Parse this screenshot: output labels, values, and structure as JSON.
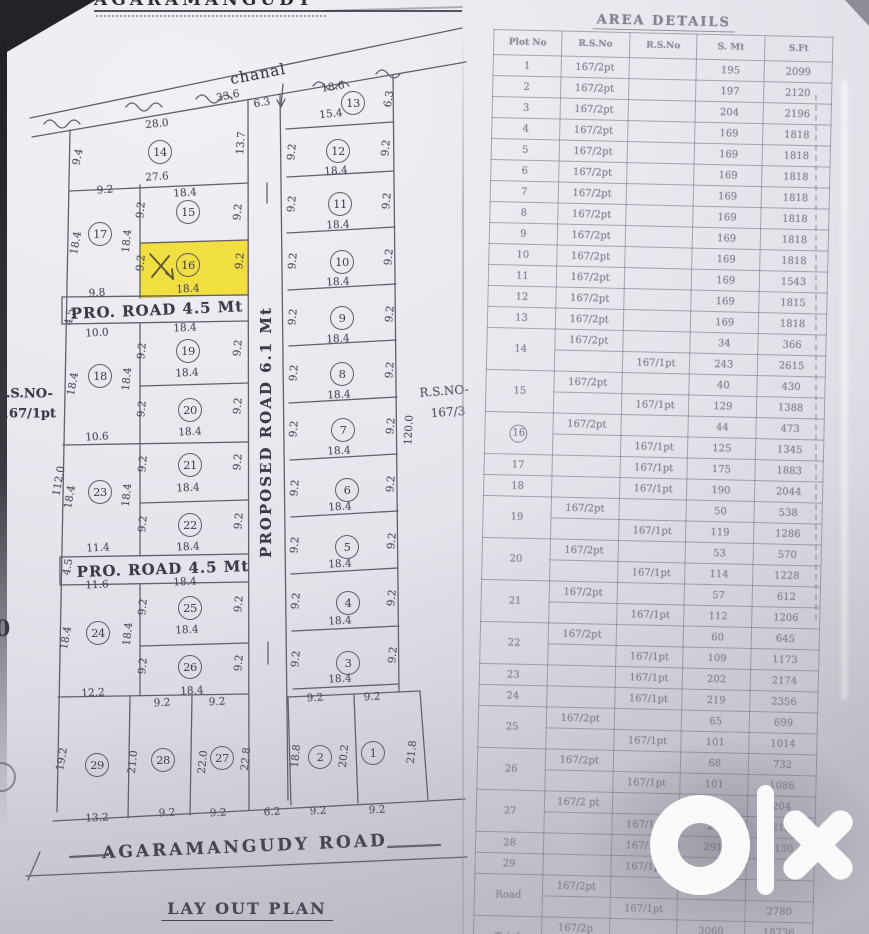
{
  "page": {
    "top_title": "AGARAMANGUDY",
    "layout_title": "LAY OUT PLAN"
  },
  "plan": {
    "channel_label": "chanal",
    "road_pro_1": "PRO. ROAD 4.5 Mt",
    "road_pro_2": "PRO. ROAD 4.5 Mt",
    "road_proposed": "PROPOSED ROAD 6.1 Mt",
    "road_main": "AGARAMANGUDY ROAD",
    "rs_left_line1": "R.S.NO-",
    "rs_left_line2": "167/1pt",
    "rs_right_line1": "R.S.NO-",
    "rs_right_line2": "167/3",
    "artifact_zero": "0",
    "highlight_color": "#f2df39",
    "highlighted_plot": "16",
    "plots": [
      {
        "n": "1",
        "x": 373,
        "y": 753
      },
      {
        "n": "2",
        "x": 320,
        "y": 757
      },
      {
        "n": "3",
        "x": 348,
        "y": 663
      },
      {
        "n": "4",
        "x": 348,
        "y": 603
      },
      {
        "n": "5",
        "x": 347,
        "y": 547
      },
      {
        "n": "6",
        "x": 347,
        "y": 490
      },
      {
        "n": "7",
        "x": 343,
        "y": 430
      },
      {
        "n": "8",
        "x": 342,
        "y": 374
      },
      {
        "n": "9",
        "x": 342,
        "y": 318
      },
      {
        "n": "10",
        "x": 342,
        "y": 262
      },
      {
        "n": "11",
        "x": 340,
        "y": 204
      },
      {
        "n": "12",
        "x": 338,
        "y": 151
      },
      {
        "n": "13",
        "x": 353,
        "y": 103
      },
      {
        "n": "14",
        "x": 160,
        "y": 152
      },
      {
        "n": "15",
        "x": 188,
        "y": 212
      },
      {
        "n": "16",
        "x": 188,
        "y": 265
      },
      {
        "n": "17",
        "x": 100,
        "y": 234
      },
      {
        "n": "18",
        "x": 100,
        "y": 376
      },
      {
        "n": "19",
        "x": 188,
        "y": 351
      },
      {
        "n": "20",
        "x": 190,
        "y": 410
      },
      {
        "n": "21",
        "x": 190,
        "y": 465
      },
      {
        "n": "22",
        "x": 190,
        "y": 525
      },
      {
        "n": "23",
        "x": 100,
        "y": 492
      },
      {
        "n": "24",
        "x": 98,
        "y": 633
      },
      {
        "n": "25",
        "x": 190,
        "y": 608
      },
      {
        "n": "26",
        "x": 190,
        "y": 667
      },
      {
        "n": "27",
        "x": 222,
        "y": 758
      },
      {
        "n": "28",
        "x": 163,
        "y": 760
      },
      {
        "n": "29",
        "x": 97,
        "y": 765
      }
    ],
    "dims": [
      {
        "t": "28.0",
        "x": 157,
        "y": 124,
        "r": -6
      },
      {
        "t": "27.6",
        "x": 157,
        "y": 177,
        "r": -4
      },
      {
        "t": "9.4",
        "x": 78,
        "y": 157,
        "r": -78
      },
      {
        "t": "13.7",
        "x": 241,
        "y": 143,
        "r": -86
      },
      {
        "t": "33.6",
        "x": 228,
        "y": 96,
        "r": -12
      },
      {
        "t": "6.3",
        "x": 262,
        "y": 103,
        "r": -10
      },
      {
        "t": "18.6",
        "x": 333,
        "y": 87,
        "r": -9
      },
      {
        "t": "15.4",
        "x": 331,
        "y": 114,
        "r": -6
      },
      {
        "t": "6.3",
        "x": 389,
        "y": 99,
        "r": -82
      },
      {
        "t": "9.2",
        "x": 292,
        "y": 152,
        "r": -84
      },
      {
        "t": "9.2",
        "x": 386,
        "y": 148,
        "r": -84
      },
      {
        "t": "18.4",
        "x": 336,
        "y": 171,
        "r": -4
      },
      {
        "t": "9.2",
        "x": 292,
        "y": 204,
        "r": -84
      },
      {
        "t": "9.2",
        "x": 387,
        "y": 201,
        "r": -84
      },
      {
        "t": "18.4",
        "x": 338,
        "y": 225,
        "r": -3
      },
      {
        "t": "9.2",
        "x": 293,
        "y": 261,
        "r": -84
      },
      {
        "t": "9.2",
        "x": 389,
        "y": 257,
        "r": -84
      },
      {
        "t": "18.4",
        "x": 338,
        "y": 282,
        "r": -3
      },
      {
        "t": "9.2",
        "x": 293,
        "y": 317,
        "r": -84
      },
      {
        "t": "9.2",
        "x": 390,
        "y": 314,
        "r": -84
      },
      {
        "t": "18.4",
        "x": 338,
        "y": 339,
        "r": -3
      },
      {
        "t": "9.2",
        "x": 294,
        "y": 373,
        "r": -84
      },
      {
        "t": "9.2",
        "x": 390,
        "y": 370,
        "r": -84
      },
      {
        "t": "18.4",
        "x": 339,
        "y": 395,
        "r": -3
      },
      {
        "t": "9.2",
        "x": 294,
        "y": 429,
        "r": -84
      },
      {
        "t": "9.2",
        "x": 391,
        "y": 426,
        "r": -84
      },
      {
        "t": "18.4",
        "x": 339,
        "y": 451,
        "r": -3
      },
      {
        "t": "9.2",
        "x": 295,
        "y": 488,
        "r": -84
      },
      {
        "t": "9.2",
        "x": 391,
        "y": 484,
        "r": -84
      },
      {
        "t": "18.4",
        "x": 340,
        "y": 507,
        "r": -3
      },
      {
        "t": "9.2",
        "x": 295,
        "y": 545,
        "r": -84
      },
      {
        "t": "9.2",
        "x": 392,
        "y": 541,
        "r": -84
      },
      {
        "t": "18.4",
        "x": 340,
        "y": 564,
        "r": -3
      },
      {
        "t": "9.2",
        "x": 296,
        "y": 601,
        "r": -84
      },
      {
        "t": "9.2",
        "x": 392,
        "y": 598,
        "r": -84
      },
      {
        "t": "18.4",
        "x": 340,
        "y": 621,
        "r": -3
      },
      {
        "t": "9.2",
        "x": 296,
        "y": 659,
        "r": -84
      },
      {
        "t": "9.2",
        "x": 393,
        "y": 655,
        "r": -84
      },
      {
        "t": "18.4",
        "x": 340,
        "y": 679,
        "r": -3
      },
      {
        "t": "120.0",
        "x": 409,
        "y": 430,
        "r": -87
      },
      {
        "t": "9.2",
        "x": 315,
        "y": 698,
        "r": -3
      },
      {
        "t": "9.2",
        "x": 372,
        "y": 697,
        "r": -3
      },
      {
        "t": "18.8",
        "x": 296,
        "y": 756,
        "r": -84
      },
      {
        "t": "20.2",
        "x": 344,
        "y": 756,
        "r": -84
      },
      {
        "t": "21.8",
        "x": 412,
        "y": 752,
        "r": -84
      },
      {
        "t": "6.2",
        "x": 272,
        "y": 812,
        "r": -3
      },
      {
        "t": "9.2",
        "x": 318,
        "y": 811,
        "r": -3
      },
      {
        "t": "9.2",
        "x": 377,
        "y": 810,
        "r": -3
      },
      {
        "t": "9.2",
        "x": 105,
        "y": 190,
        "r": -4
      },
      {
        "t": "18.4",
        "x": 76,
        "y": 243,
        "r": -80
      },
      {
        "t": "18.4",
        "x": 127,
        "y": 241,
        "r": -84
      },
      {
        "t": "18.4",
        "x": 185,
        "y": 193,
        "r": -4
      },
      {
        "t": "9.2",
        "x": 141,
        "y": 210,
        "r": -84
      },
      {
        "t": "9.2",
        "x": 238,
        "y": 212,
        "r": -84
      },
      {
        "t": "9.2",
        "x": 141,
        "y": 263,
        "r": -84
      },
      {
        "t": "9.2",
        "x": 240,
        "y": 261,
        "r": -84
      },
      {
        "t": "18.4",
        "x": 188,
        "y": 289,
        "r": -3
      },
      {
        "t": "9.8",
        "x": 97,
        "y": 293,
        "r": -4
      },
      {
        "t": "4.5",
        "x": 70,
        "y": 317,
        "r": -80
      },
      {
        "t": "10.0",
        "x": 97,
        "y": 333,
        "r": -3
      },
      {
        "t": "18.4",
        "x": 185,
        "y": 328,
        "r": -3
      },
      {
        "t": "18.4",
        "x": 73,
        "y": 384,
        "r": -80
      },
      {
        "t": "18.4",
        "x": 127,
        "y": 379,
        "r": -84
      },
      {
        "t": "9.2",
        "x": 142,
        "y": 351,
        "r": -84
      },
      {
        "t": "9.2",
        "x": 238,
        "y": 348,
        "r": -84
      },
      {
        "t": "18.4",
        "x": 187,
        "y": 373,
        "r": -3
      },
      {
        "t": "9.2",
        "x": 142,
        "y": 409,
        "r": -84
      },
      {
        "t": "9.2",
        "x": 238,
        "y": 406,
        "r": -84
      },
      {
        "t": "18.4",
        "x": 190,
        "y": 432,
        "r": -3
      },
      {
        "t": "10.6",
        "x": 97,
        "y": 437,
        "r": -3
      },
      {
        "t": "112.0",
        "x": 59,
        "y": 481,
        "r": -80
      },
      {
        "t": "18.4",
        "x": 70,
        "y": 497,
        "r": -80
      },
      {
        "t": "18.4",
        "x": 127,
        "y": 495,
        "r": -84
      },
      {
        "t": "9.2",
        "x": 143,
        "y": 464,
        "r": -84
      },
      {
        "t": "9.2",
        "x": 238,
        "y": 462,
        "r": -84
      },
      {
        "t": "18.4",
        "x": 188,
        "y": 488,
        "r": -3
      },
      {
        "t": "9.2",
        "x": 143,
        "y": 524,
        "r": -84
      },
      {
        "t": "9.2",
        "x": 239,
        "y": 521,
        "r": -84
      },
      {
        "t": "18.4",
        "x": 188,
        "y": 547,
        "r": -3
      },
      {
        "t": "11.4",
        "x": 98,
        "y": 548,
        "r": -3
      },
      {
        "t": "4.5",
        "x": 68,
        "y": 567,
        "r": -80
      },
      {
        "t": "11.6",
        "x": 97,
        "y": 585,
        "r": -3
      },
      {
        "t": "18.4",
        "x": 185,
        "y": 582,
        "r": -3
      },
      {
        "t": "9.2",
        "x": 143,
        "y": 607,
        "r": -84
      },
      {
        "t": "9.2",
        "x": 239,
        "y": 604,
        "r": -84
      },
      {
        "t": "18.4",
        "x": 187,
        "y": 630,
        "r": -3
      },
      {
        "t": "18.4",
        "x": 66,
        "y": 638,
        "r": -80
      },
      {
        "t": "18.4",
        "x": 128,
        "y": 634,
        "r": -84
      },
      {
        "t": "9.2",
        "x": 143,
        "y": 666,
        "r": -84
      },
      {
        "t": "9.2",
        "x": 239,
        "y": 663,
        "r": -84
      },
      {
        "t": "18.4",
        "x": 192,
        "y": 691,
        "r": -3
      },
      {
        "t": "12.2",
        "x": 93,
        "y": 693,
        "r": -3
      },
      {
        "t": "9.2",
        "x": 162,
        "y": 703,
        "r": -3
      },
      {
        "t": "9.2",
        "x": 217,
        "y": 702,
        "r": -3
      },
      {
        "t": "19.2",
        "x": 62,
        "y": 759,
        "r": -80
      },
      {
        "t": "21.0",
        "x": 133,
        "y": 762,
        "r": -84
      },
      {
        "t": "22.0",
        "x": 203,
        "y": 762,
        "r": -84
      },
      {
        "t": "22.8",
        "x": 246,
        "y": 759,
        "r": -84
      },
      {
        "t": "13.2",
        "x": 97,
        "y": 818,
        "r": -3
      },
      {
        "t": "9.2",
        "x": 167,
        "y": 813,
        "r": -3
      },
      {
        "t": "9.2",
        "x": 218,
        "y": 813,
        "r": -3
      }
    ]
  },
  "table": {
    "title": "AREA DETAILS",
    "headers": [
      "Plot No",
      "R.S.No",
      "R.S.No",
      "S. Mt",
      "S.Ft"
    ],
    "rows": [
      {
        "no": "1",
        "subs": [
          {
            "rs2": "167/2pt",
            "rs1": "",
            "smt": "195",
            "sft": "2099"
          }
        ]
      },
      {
        "no": "2",
        "subs": [
          {
            "rs2": "167/2pt",
            "rs1": "",
            "smt": "197",
            "sft": "2120"
          }
        ]
      },
      {
        "no": "3",
        "subs": [
          {
            "rs2": "167/2pt",
            "rs1": "",
            "smt": "204",
            "sft": "2196"
          }
        ]
      },
      {
        "no": "4",
        "subs": [
          {
            "rs2": "167/2pt",
            "rs1": "",
            "smt": "169",
            "sft": "1818"
          }
        ]
      },
      {
        "no": "5",
        "subs": [
          {
            "rs2": "167/2pt",
            "rs1": "",
            "smt": "169",
            "sft": "1818"
          }
        ]
      },
      {
        "no": "6",
        "subs": [
          {
            "rs2": "167/2pt",
            "rs1": "",
            "smt": "169",
            "sft": "1818"
          }
        ]
      },
      {
        "no": "7",
        "subs": [
          {
            "rs2": "167/2pt",
            "rs1": "",
            "smt": "169",
            "sft": "1818"
          }
        ]
      },
      {
        "no": "8",
        "subs": [
          {
            "rs2": "167/2pt",
            "rs1": "",
            "smt": "169",
            "sft": "1818"
          }
        ]
      },
      {
        "no": "9",
        "subs": [
          {
            "rs2": "167/2pt",
            "rs1": "",
            "smt": "169",
            "sft": "1818"
          }
        ]
      },
      {
        "no": "10",
        "subs": [
          {
            "rs2": "167/2pt",
            "rs1": "",
            "smt": "169",
            "sft": "1818"
          }
        ]
      },
      {
        "no": "11",
        "subs": [
          {
            "rs2": "167/2pt",
            "rs1": "",
            "smt": "169",
            "sft": "1543"
          }
        ]
      },
      {
        "no": "12",
        "subs": [
          {
            "rs2": "167/2pt",
            "rs1": "",
            "smt": "169",
            "sft": "1815"
          }
        ]
      },
      {
        "no": "13",
        "subs": [
          {
            "rs2": "167/2pt",
            "rs1": "",
            "smt": "169",
            "sft": "1818"
          }
        ]
      },
      {
        "no": "14",
        "subs": [
          {
            "rs2": "167/2pt",
            "rs1": "",
            "smt": "34",
            "sft": "366"
          },
          {
            "rs2": "",
            "rs1": "167/1pt",
            "smt": "243",
            "sft": "2615"
          }
        ]
      },
      {
        "no": "15",
        "subs": [
          {
            "rs2": "167/2pt",
            "rs1": "",
            "smt": "40",
            "sft": "430"
          },
          {
            "rs2": "",
            "rs1": "167/1pt",
            "smt": "129",
            "sft": "1388"
          }
        ]
      },
      {
        "no": "16",
        "circled": true,
        "subs": [
          {
            "rs2": "167/2pt",
            "rs1": "",
            "smt": "44",
            "sft": "473"
          },
          {
            "rs2": "",
            "rs1": "167/1pt",
            "smt": "125",
            "sft": "1345"
          }
        ]
      },
      {
        "no": "17",
        "subs": [
          {
            "rs2": "",
            "rs1": "167/1pt",
            "smt": "175",
            "sft": "1883"
          }
        ]
      },
      {
        "no": "18",
        "subs": [
          {
            "rs2": "",
            "rs1": "167/1pt",
            "smt": "190",
            "sft": "2044"
          }
        ]
      },
      {
        "no": "19",
        "subs": [
          {
            "rs2": "167/2pt",
            "rs1": "",
            "smt": "50",
            "sft": "538"
          },
          {
            "rs2": "",
            "rs1": "167/1pt",
            "smt": "119",
            "sft": "1286"
          }
        ]
      },
      {
        "no": "20",
        "subs": [
          {
            "rs2": "167/2pt",
            "rs1": "",
            "smt": "53",
            "sft": "570"
          },
          {
            "rs2": "",
            "rs1": "167/1pt",
            "smt": "114",
            "sft": "1228"
          }
        ]
      },
      {
        "no": "21",
        "subs": [
          {
            "rs2": "167/2pt",
            "rs1": "",
            "smt": "57",
            "sft": "612"
          },
          {
            "rs2": "",
            "rs1": "167/1pt",
            "smt": "112",
            "sft": "1206"
          }
        ]
      },
      {
        "no": "22",
        "subs": [
          {
            "rs2": "167/2pt",
            "rs1": "",
            "smt": "60",
            "sft": "645"
          },
          {
            "rs2": "",
            "rs1": "167/1pt",
            "smt": "109",
            "sft": "1173"
          }
        ]
      },
      {
        "no": "23",
        "subs": [
          {
            "rs2": "",
            "rs1": "167/1pt",
            "smt": "202",
            "sft": "2174"
          }
        ]
      },
      {
        "no": "24",
        "subs": [
          {
            "rs2": "",
            "rs1": "167/1pt",
            "smt": "219",
            "sft": "2356"
          }
        ]
      },
      {
        "no": "25",
        "subs": [
          {
            "rs2": "167/2pt",
            "rs1": "",
            "smt": "65",
            "sft": "699"
          },
          {
            "rs2": "",
            "rs1": "167/1pt",
            "smt": "101",
            "sft": "1014"
          }
        ]
      },
      {
        "no": "26",
        "subs": [
          {
            "rs2": "167/2pt",
            "rs1": "",
            "smt": "68",
            "sft": "732"
          },
          {
            "rs2": "",
            "rs1": "167/1pt",
            "smt": "101",
            "sft": "1086"
          }
        ]
      },
      {
        "no": "27",
        "subs": [
          {
            "rs2": "167/2 pt",
            "rs1": "",
            "smt": "19",
            "sft": "204"
          },
          {
            "rs2": "",
            "rs1": "167/1pt",
            "smt": "20",
            "sft": "215"
          }
        ]
      },
      {
        "no": "28",
        "subs": [
          {
            "rs2": "",
            "rs1": "167/1pt",
            "smt": "291",
            "sft": "3130"
          }
        ]
      },
      {
        "no": "29",
        "subs": [
          {
            "rs2": "",
            "rs1": "167/1pt",
            "smt": "",
            "sft": ""
          }
        ]
      },
      {
        "no": "Road",
        "subs": [
          {
            "rs2": "167/2pt",
            "rs1": "",
            "smt": "",
            "sft": ""
          },
          {
            "rs2": "",
            "rs1": "167/1pt",
            "smt": "",
            "sft": "2780"
          }
        ]
      },
      {
        "no": "Total",
        "subs": [
          {
            "rs2": "167/2p",
            "rs1": "",
            "smt": "3060",
            "sft": "18736"
          },
          {
            "rs2": "",
            "rs1": "167/1p",
            "smt": "2676",
            "sft": "28744"
          }
        ]
      }
    ]
  },
  "watermark": {
    "name": "olx-logo"
  }
}
